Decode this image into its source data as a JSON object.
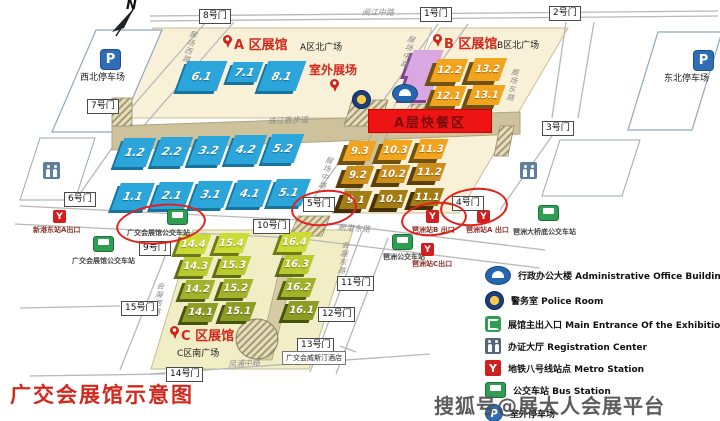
{
  "compass": "N",
  "title": "广交会展馆示意图",
  "watermark": "搜狐号@展大人会展平台",
  "banner": {
    "text": "A层快餐区",
    "x": 368,
    "y": 109,
    "w": 122,
    "h": 22
  },
  "hotel": {
    "text": "广交会威斯汀酒店",
    "x": 282,
    "y": 351
  },
  "area_labels": [
    {
      "text": "A 区展馆",
      "x": 234,
      "y": 34,
      "style": "red",
      "size": 13
    },
    {
      "text": "室外展场",
      "x": 309,
      "y": 61,
      "style": "red",
      "size": 12
    },
    {
      "text": "B 区展馆",
      "x": 444,
      "y": 33,
      "style": "red",
      "size": 13
    },
    {
      "text": "C 区展馆",
      "x": 181,
      "y": 325,
      "style": "red",
      "size": 13
    },
    {
      "text": "A区北广场",
      "x": 300,
      "y": 40,
      "style": "black",
      "size": 9
    },
    {
      "text": "B区北广场",
      "x": 497,
      "y": 38,
      "style": "black",
      "size": 9
    },
    {
      "text": "C区南广场",
      "x": 177,
      "y": 346,
      "style": "black",
      "size": 9
    },
    {
      "text": "西北停车场",
      "x": 80,
      "y": 70,
      "style": "black",
      "size": 9
    },
    {
      "text": "东北停车场",
      "x": 664,
      "y": 71,
      "style": "black",
      "size": 9
    }
  ],
  "pins": [
    {
      "x": 223,
      "y": 35
    },
    {
      "x": 330,
      "y": 79
    },
    {
      "x": 433,
      "y": 34
    },
    {
      "x": 170,
      "y": 326
    }
  ],
  "road_labels": [
    {
      "text": "阅江中路",
      "x": 362,
      "y": 7,
      "vert": false,
      "rot": 0
    },
    {
      "text": "新港东路",
      "x": 338,
      "y": 223,
      "vert": false,
      "rot": 4
    },
    {
      "text": "凤浦中路",
      "x": 228,
      "y": 358,
      "vert": false,
      "rot": -4
    },
    {
      "text": "珠江散步道",
      "x": 268,
      "y": 115,
      "vert": false,
      "rot": -2
    },
    {
      "text": "展场西路",
      "x": 184,
      "y": 30,
      "vert": true,
      "rot": 15
    },
    {
      "text": "展场中路",
      "x": 402,
      "y": 35,
      "vert": true,
      "rot": 15
    },
    {
      "text": "展场中路",
      "x": 320,
      "y": 156,
      "vert": true,
      "rot": 15
    },
    {
      "text": "展场东路",
      "x": 507,
      "y": 68,
      "vert": true,
      "rot": 10
    },
    {
      "text": "会展东路",
      "x": 338,
      "y": 241,
      "vert": true,
      "rot": 8
    },
    {
      "text": "会展西路",
      "x": 153,
      "y": 282,
      "vert": true,
      "rot": 8
    }
  ],
  "gates": [
    {
      "name": "1号门",
      "x": 420,
      "y": 7
    },
    {
      "name": "2号门",
      "x": 549,
      "y": 6
    },
    {
      "name": "3号门",
      "x": 542,
      "y": 121
    },
    {
      "name": "4号门",
      "x": 452,
      "y": 196
    },
    {
      "name": "5号门",
      "x": 303,
      "y": 197
    },
    {
      "name": "6号门",
      "x": 64,
      "y": 192
    },
    {
      "name": "7号门",
      "x": 87,
      "y": 99
    },
    {
      "name": "8号门",
      "x": 199,
      "y": 9
    },
    {
      "name": "9号门",
      "x": 139,
      "y": 241
    },
    {
      "name": "10号门",
      "x": 253,
      "y": 219
    },
    {
      "name": "11号门",
      "x": 337,
      "y": 276
    },
    {
      "name": "12号门",
      "x": 318,
      "y": 307
    },
    {
      "name": "13号门",
      "x": 297,
      "y": 338
    },
    {
      "name": "14号门",
      "x": 166,
      "y": 367
    },
    {
      "name": "15号门",
      "x": 121,
      "y": 301
    }
  ],
  "halls": [
    {
      "n": "6.1",
      "x": 182,
      "y": 61,
      "w": 40,
      "h": 30,
      "c": "blue"
    },
    {
      "n": "7.1",
      "x": 230,
      "y": 62,
      "w": 30,
      "h": 20,
      "c": "blue"
    },
    {
      "n": "8.1",
      "x": 263,
      "y": 61,
      "w": 38,
      "h": 30,
      "c": "blue"
    },
    {
      "n": "1.2",
      "x": 119,
      "y": 138,
      "w": 32,
      "h": 29,
      "c": "blue"
    },
    {
      "n": "2.2",
      "x": 156,
      "y": 137,
      "w": 32,
      "h": 29,
      "c": "blue"
    },
    {
      "n": "3.2",
      "x": 193,
      "y": 136,
      "w": 32,
      "h": 29,
      "c": "blue"
    },
    {
      "n": "4.2",
      "x": 230,
      "y": 135,
      "w": 32,
      "h": 29,
      "c": "blue"
    },
    {
      "n": "5.2",
      "x": 267,
      "y": 134,
      "w": 32,
      "h": 29,
      "c": "blue"
    },
    {
      "n": "1.1",
      "x": 116,
      "y": 183,
      "w": 34,
      "h": 27,
      "c": "blue"
    },
    {
      "n": "2.1",
      "x": 155,
      "y": 182,
      "w": 34,
      "h": 27,
      "c": "blue"
    },
    {
      "n": "3.1",
      "x": 194,
      "y": 181,
      "w": 34,
      "h": 27,
      "c": "blue"
    },
    {
      "n": "4.1",
      "x": 233,
      "y": 180,
      "w": 34,
      "h": 27,
      "c": "blue"
    },
    {
      "n": "5.1",
      "x": 272,
      "y": 179,
      "w": 34,
      "h": 27,
      "c": "blue"
    },
    {
      "n": "",
      "x": 409,
      "y": 50,
      "w": 30,
      "h": 26,
      "c": "pink"
    },
    {
      "n": "",
      "x": 404,
      "y": 76,
      "w": 30,
      "h": 24,
      "c": "pink"
    },
    {
      "n": "12.2",
      "x": 434,
      "y": 59,
      "w": 30,
      "h": 23,
      "c": "or3"
    },
    {
      "n": "13.2",
      "x": 471,
      "y": 58,
      "w": 32,
      "h": 23,
      "c": "or3"
    },
    {
      "n": "12.1",
      "x": 433,
      "y": 86,
      "w": 30,
      "h": 20,
      "c": "or3"
    },
    {
      "n": "13.1",
      "x": 470,
      "y": 85,
      "w": 32,
      "h": 20,
      "c": "or3"
    },
    {
      "n": "9.3",
      "x": 346,
      "y": 141,
      "w": 27,
      "h": 20,
      "c": "or3"
    },
    {
      "n": "10.3",
      "x": 381,
      "y": 140,
      "w": 28,
      "h": 20,
      "c": "or3"
    },
    {
      "n": "11.3",
      "x": 417,
      "y": 139,
      "w": 28,
      "h": 20,
      "c": "or3"
    },
    {
      "n": "9.2",
      "x": 344,
      "y": 166,
      "w": 27,
      "h": 18,
      "c": "or2"
    },
    {
      "n": "10.2",
      "x": 379,
      "y": 165,
      "w": 28,
      "h": 18,
      "c": "or2"
    },
    {
      "n": "11.2",
      "x": 415,
      "y": 163,
      "w": 28,
      "h": 18,
      "c": "or2"
    },
    {
      "n": "9.1",
      "x": 342,
      "y": 191,
      "w": 27,
      "h": 18,
      "c": "or1"
    },
    {
      "n": "10.1",
      "x": 377,
      "y": 190,
      "w": 28,
      "h": 18,
      "c": "or1"
    },
    {
      "n": "11.1",
      "x": 413,
      "y": 188,
      "w": 28,
      "h": 18,
      "c": "or1"
    },
    {
      "n": "14.4",
      "x": 179,
      "y": 234,
      "w": 29,
      "h": 20,
      "c": "g4"
    },
    {
      "n": "15.4",
      "x": 217,
      "y": 233,
      "w": 29,
      "h": 20,
      "c": "g4"
    },
    {
      "n": "16.4",
      "x": 280,
      "y": 232,
      "w": 29,
      "h": 20,
      "c": "g4"
    },
    {
      "n": "14.3",
      "x": 181,
      "y": 257,
      "w": 29,
      "h": 19,
      "c": "g3"
    },
    {
      "n": "15.3",
      "x": 219,
      "y": 256,
      "w": 29,
      "h": 19,
      "c": "g3"
    },
    {
      "n": "16.3",
      "x": 282,
      "y": 255,
      "w": 29,
      "h": 19,
      "c": "g3"
    },
    {
      "n": "14.2",
      "x": 183,
      "y": 280,
      "w": 29,
      "h": 19,
      "c": "g2"
    },
    {
      "n": "15.2",
      "x": 221,
      "y": 279,
      "w": 29,
      "h": 19,
      "c": "g2"
    },
    {
      "n": "16.2",
      "x": 284,
      "y": 278,
      "w": 29,
      "h": 19,
      "c": "g2"
    },
    {
      "n": "14.1",
      "x": 185,
      "y": 303,
      "w": 30,
      "h": 19,
      "c": "g1"
    },
    {
      "n": "15.1",
      "x": 223,
      "y": 302,
      "w": 30,
      "h": 19,
      "c": "g1"
    },
    {
      "n": "16.1",
      "x": 286,
      "y": 301,
      "w": 30,
      "h": 19,
      "c": "g1"
    }
  ],
  "ellipses": [
    {
      "x": 116,
      "y": 204,
      "w": 86,
      "h": 36,
      "rot": -6
    },
    {
      "x": 291,
      "y": 190,
      "w": 62,
      "h": 32,
      "rot": -6
    },
    {
      "x": 401,
      "y": 202,
      "w": 62,
      "h": 30,
      "rot": -6
    },
    {
      "x": 440,
      "y": 188,
      "w": 64,
      "h": 34,
      "rot": -6
    }
  ],
  "metro_stations": [
    {
      "label": "新港东站A出口",
      "lx": 33,
      "ly": 225,
      "ix": 53,
      "iy": 210
    },
    {
      "label": "琶洲站B 出口",
      "lx": 412,
      "ly": 225,
      "ix": 426,
      "iy": 210
    },
    {
      "label": "琶洲站A 出口",
      "lx": 466,
      "ly": 225,
      "ix": 477,
      "iy": 210
    },
    {
      "label": "琶洲站C出口",
      "lx": 412,
      "ly": 259,
      "ix": 421,
      "iy": 243
    }
  ],
  "bus_stations": [
    {
      "label": "广交会展馆公交车站",
      "lx": 127,
      "ly": 228,
      "ix": 167,
      "iy": 209
    },
    {
      "label": "广交会展馆公交车站",
      "lx": 72,
      "ly": 256,
      "ix": 93,
      "iy": 236
    },
    {
      "label": "琶洲公交车站",
      "lx": 383,
      "ly": 252,
      "ix": 392,
      "iy": 234
    },
    {
      "label": "琶洲大桥底公交车站",
      "lx": 513,
      "ly": 227,
      "ix": 538,
      "iy": 205
    }
  ],
  "parking_icons": [
    {
      "x": 100,
      "y": 49
    },
    {
      "x": 693,
      "y": 50
    }
  ],
  "misc_icons": {
    "police": {
      "x": 352,
      "y": 90
    },
    "admin": {
      "x": 392,
      "y": 84
    },
    "toilets": [
      {
        "x": 520,
        "y": 162
      },
      {
        "x": 43,
        "y": 162
      }
    ]
  },
  "legend": {
    "items": [
      {
        "icon": "admin-building-icon",
        "label": "行政办公大楼 Administrative Office Building"
      },
      {
        "icon": "police-icon",
        "label": "警务室 Police Room"
      },
      {
        "icon": "main-entrance-icon",
        "label": "展馆主出入口 Main Entrance Of the Exhibition Hall"
      },
      {
        "icon": "registration-icon",
        "label": "办证大厅 Registration Center"
      },
      {
        "icon": "metro-icon",
        "label": "地铁八号线站点 Metro Station"
      },
      {
        "icon": "bus-icon",
        "label": "公交车站 Bus Station"
      },
      {
        "icon": "parking-icon",
        "label": "室外停车场"
      }
    ]
  }
}
